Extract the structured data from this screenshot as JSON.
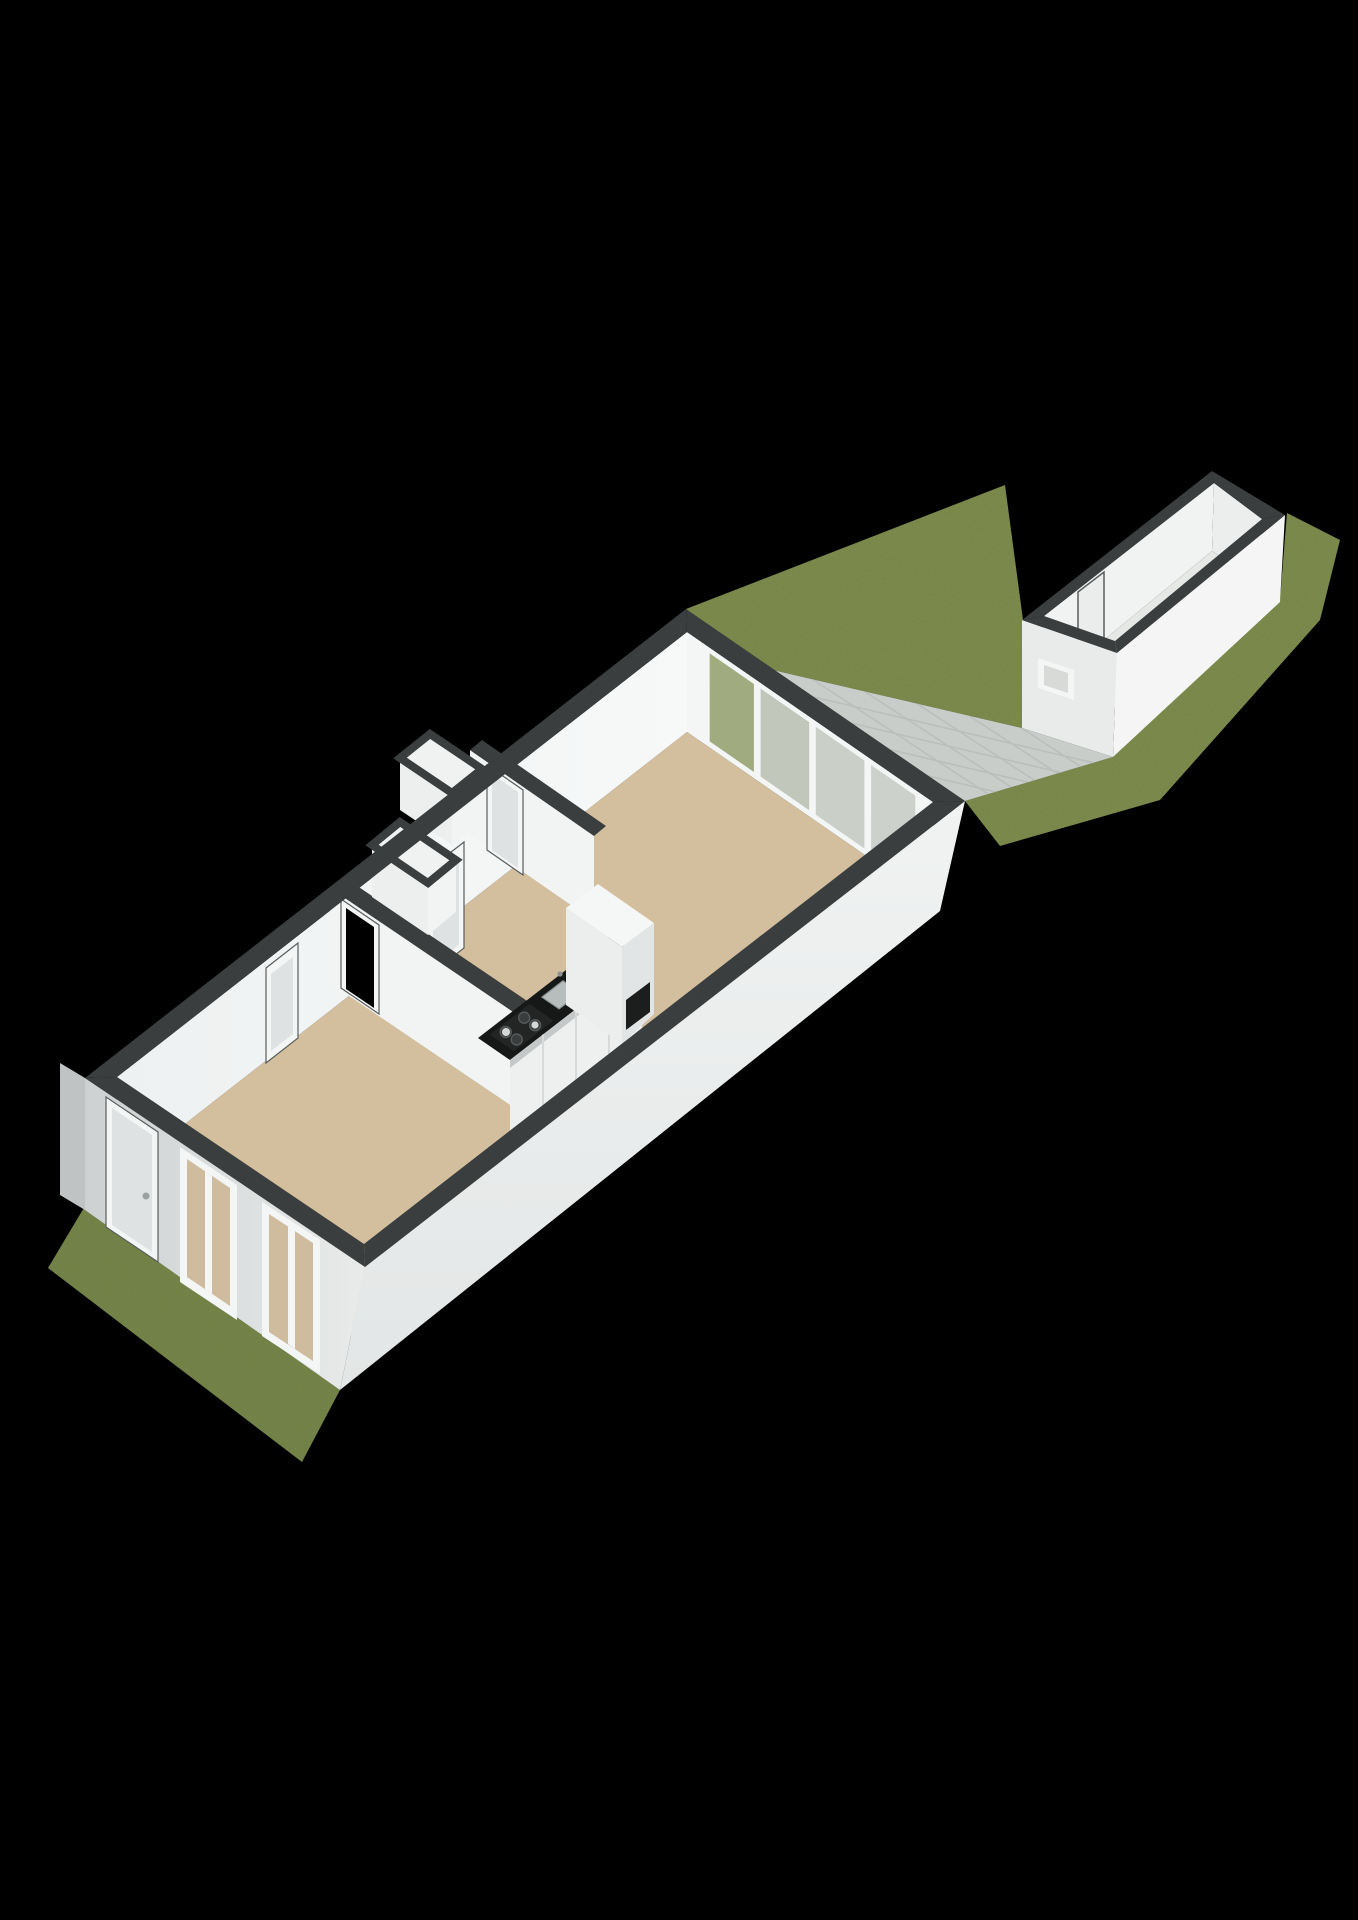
{
  "palette": {
    "background": "#000000",
    "grassMain": "#7e8c4e",
    "grassFront": "#75854a",
    "patio": "#c9cdc9",
    "patioLine": "#b8bcb8",
    "bandDark": "#3a3e3e",
    "facadeSWa": "#cdd1d1",
    "facadeSWb": "#e9ebeb",
    "facadeSliver": "#bfc3c3",
    "facadeSE": "#f1f3f3",
    "facadeSEb": "#e3e6e6",
    "wallInner": "#eef1f1",
    "wallInnerBright": "#f7f9f9",
    "wallFace": "#f2f4f4",
    "floorTan": "#d3bf9d",
    "windowPane": "#cfbc9e",
    "frameWhite": "#f4f6f6",
    "doorLeaf": "#dfe2e2",
    "doorJamb": "#5a5e5e",
    "handleGray": "#9aa0a0",
    "counterTop": "#161717",
    "counterFront": "#eef0f0",
    "counterSeam": "#d7dada",
    "counterShadow": "#9b9f9f",
    "hob": "#232525",
    "burner": "#3a3d3d",
    "burnerRim": "#565a5a",
    "panWhite": "#e8e9e9",
    "steel": "#b7bcbd",
    "steelDark": "#8e9394",
    "fridgeTop": "#f5f6f6",
    "fridgeSW": "#eceeee",
    "fridgeSE": "#e2e5e5",
    "fridgeSlot": "#1c1d1d",
    "glassGreen": "#a0ab80",
    "glassGray1": "#c1c7bb",
    "glassGray2": "#cacfc7",
    "glassGray3": "#cdd1cc",
    "shedOuterBright": "#f4f5f4",
    "shedOuterShade": "#e8ebea",
    "shedInnerNW": "#f1f3f3",
    "shedInnerNE": "#eceeee",
    "shedInnerSE": "#f4f5f5",
    "shedFloor": "#e6e8e6",
    "shedDoor": "#ebedec",
    "shedWinPane": "#d8dad8",
    "nicheFill": "#f0f2f2",
    "nicheFaceA": "#edefef",
    "nicheFaceB": "#f2f3f3"
  }
}
